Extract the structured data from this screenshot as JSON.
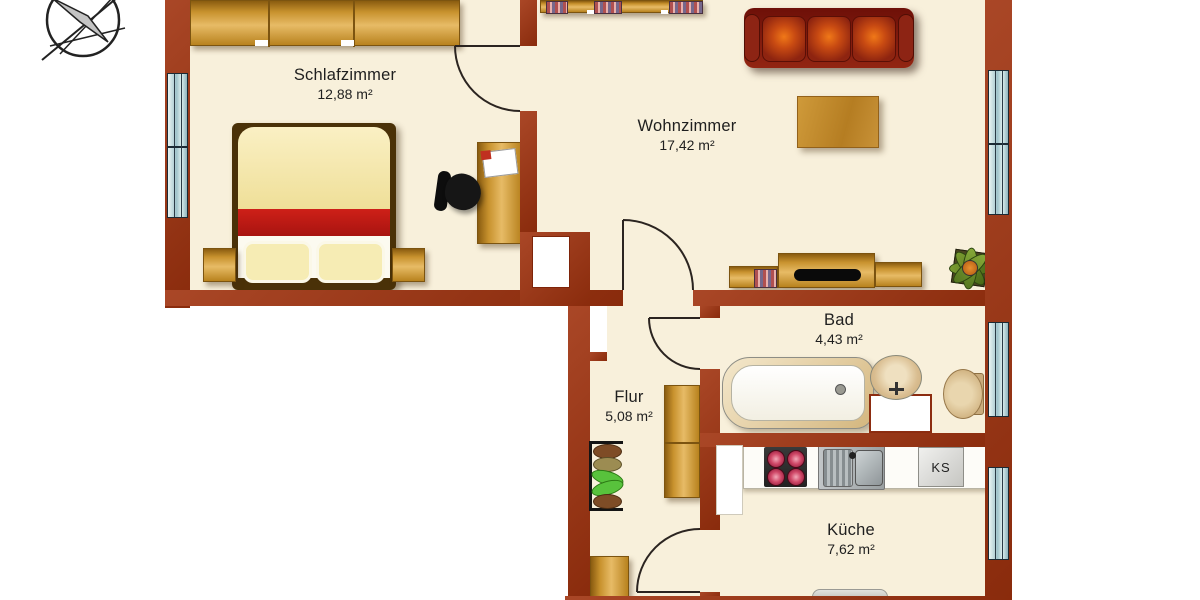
{
  "rooms": [
    {
      "name": "Schlafzimmer",
      "area": "12,88 m²"
    },
    {
      "name": "Wohnzimmer",
      "area": "17,42 m²"
    },
    {
      "name": "Bad",
      "area": "4,43 m²"
    },
    {
      "name": "Flur",
      "area": "5,08 m²"
    },
    {
      "name": "Küche",
      "area": "7,62 m²"
    }
  ],
  "kitchen": {
    "fridge_label": "KS"
  },
  "colors": {
    "background": "#ffffff",
    "wall": "#a0320e",
    "floor": "#f8f0db",
    "window": "#afd0d6",
    "wood": "#c8922e",
    "sofa": "#8a1c0e",
    "bed_stripe": "#ce2018",
    "plant": "#5c8024"
  }
}
